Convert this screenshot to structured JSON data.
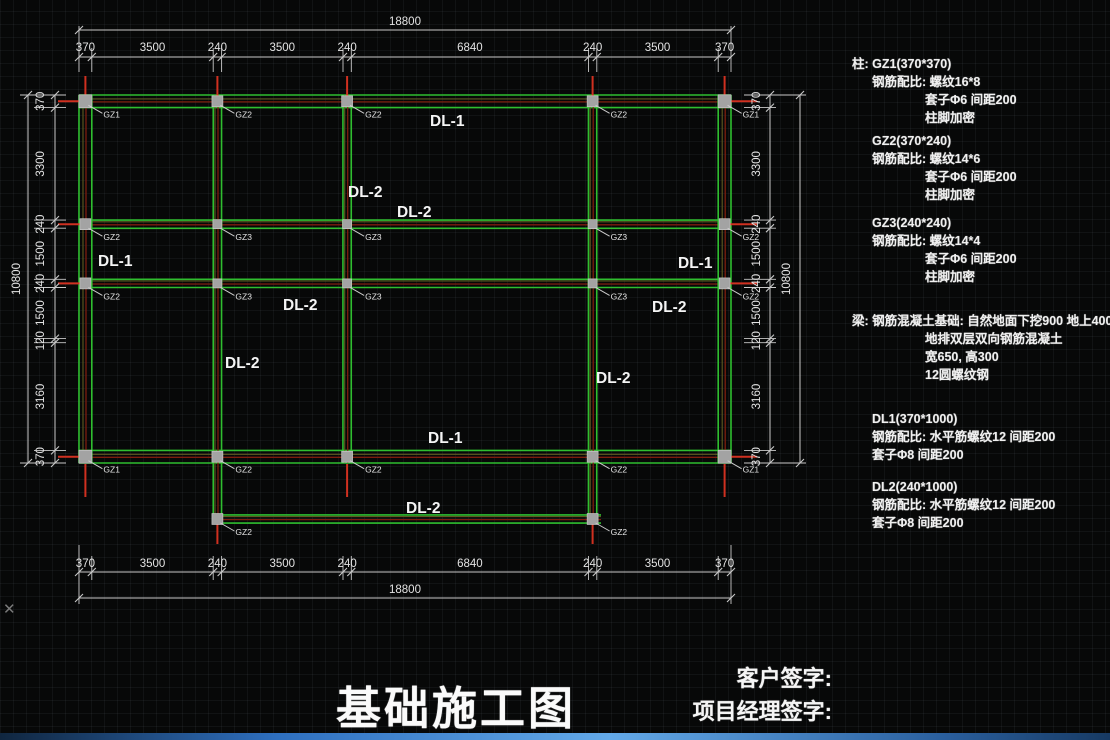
{
  "title": "基础施工图",
  "signatures": {
    "client": "客户签字:",
    "manager": "项目经理签字:"
  },
  "notes_lines": [
    {
      "t": "柱: GZ1(370*370)",
      "ind": 0,
      "gap": 0
    },
    {
      "t": "钢筋配比: 螺纹16*8",
      "ind": 1,
      "gap": 2
    },
    {
      "t": "套子Φ6 间距200",
      "ind": 2,
      "gap": 2
    },
    {
      "t": "柱脚加密",
      "ind": 2,
      "gap": 2
    },
    {
      "t": "GZ2(370*240)",
      "ind": 1,
      "gap": 7
    },
    {
      "t": "钢筋配比: 螺纹14*6",
      "ind": 1,
      "gap": 2
    },
    {
      "t": "套子Φ6 间距200",
      "ind": 2,
      "gap": 2
    },
    {
      "t": "柱脚加密",
      "ind": 2,
      "gap": 2
    },
    {
      "t": "GZ3(240*240)",
      "ind": 1,
      "gap": 12
    },
    {
      "t": "钢筋配比: 螺纹14*4",
      "ind": 1,
      "gap": 2
    },
    {
      "t": "套子Φ6 间距200",
      "ind": 2,
      "gap": 2
    },
    {
      "t": "柱脚加密",
      "ind": 2,
      "gap": 2
    },
    {
      "t": "梁: 钢筋混凝土基础: 自然地面下挖900 地上400",
      "ind": 0,
      "gap": 28
    },
    {
      "t": "地排双层双向钢筋混凝土",
      "ind": 2,
      "gap": 2
    },
    {
      "t": "宽650, 高300",
      "ind": 2,
      "gap": 2
    },
    {
      "t": "12圆螺纹钢",
      "ind": 2,
      "gap": 2
    },
    {
      "t": "DL1(370*1000)",
      "ind": 1,
      "gap": 28
    },
    {
      "t": "钢筋配比: 水平筋螺纹12 间距200",
      "ind": 1,
      "gap": 2
    },
    {
      "t": "套子Φ8 间距200",
      "ind": 1,
      "gap": 2
    },
    {
      "t": "DL2(240*1000)",
      "ind": 1,
      "gap": 16
    },
    {
      "t": "钢筋配比: 水平筋螺纹12 间距200",
      "ind": 1,
      "gap": 2
    },
    {
      "t": "套子Φ8 间距200",
      "ind": 1,
      "gap": 2
    }
  ],
  "colors": {
    "green": "#2fbe2f",
    "bright_red": "#d03020",
    "dark_red": "#7d1d0e",
    "olive": "#5f5a22",
    "column_gray": "#a3a3a3",
    "column_edge": "#d0d0d0",
    "dim_line": "#c9c9c9",
    "dim_text": "#e3e3e3",
    "label_white": "#f5f5f5",
    "leader": "#cccccc"
  },
  "plan": {
    "extent": {
      "x0": 79,
      "x1": 731,
      "y0": 95,
      "y1": 463
    },
    "cols": [
      {
        "x": 85.4,
        "w": 12.8
      },
      {
        "x": 217.4,
        "w": 8.3
      },
      {
        "x": 347.1,
        "w": 8.3
      },
      {
        "x": 592.6,
        "w": 8.3
      },
      {
        "x": 724.6,
        "w": 12.8
      }
    ],
    "rows": [
      {
        "y": 101.3,
        "w": 12.6
      },
      {
        "y": 224.2,
        "w": 8.2
      },
      {
        "y": 283.4,
        "w": 8.2
      },
      {
        "y": 456.7,
        "w": 12.6
      }
    ],
    "extra_beam": {
      "y": 519,
      "x0": 217.4,
      "x1": 601,
      "w": 8.2
    },
    "x_bounds": [
      79,
      91.8,
      213.2,
      221.6,
      343,
      351.3,
      588.5,
      596.8,
      718.2,
      731
    ],
    "y_bounds": [
      95,
      107.6,
      220.1,
      228.2,
      279.3,
      287.5,
      338.6,
      342.7,
      450.4,
      463
    ],
    "dim_top": {
      "total": "18800",
      "segments": [
        "370",
        "3500",
        "240",
        "3500",
        "240",
        "6840",
        "240",
        "3500",
        "370"
      ]
    },
    "dim_bottom": {
      "total": "18800",
      "segments": [
        "370",
        "3500",
        "240",
        "3500",
        "240",
        "6840",
        "240",
        "3500",
        "370"
      ]
    },
    "dim_left": {
      "total": "10800",
      "segments": [
        "370",
        "3300",
        "240",
        "1500",
        "240",
        "1500",
        "120",
        "3160",
        "370"
      ]
    },
    "dim_right": {
      "total": "10800",
      "segments": [
        "370",
        "3300",
        "240",
        "1500",
        "240",
        "1500",
        "120",
        "3160",
        "370"
      ]
    },
    "beam_labels": [
      {
        "t": "DL-1",
        "x": 430,
        "y": 126
      },
      {
        "t": "DL-2",
        "x": 348,
        "y": 197
      },
      {
        "t": "DL-2",
        "x": 397,
        "y": 217
      },
      {
        "t": "DL-1",
        "x": 98,
        "y": 266
      },
      {
        "t": "DL-2",
        "x": 283,
        "y": 310
      },
      {
        "t": "DL-2",
        "x": 652,
        "y": 312
      },
      {
        "t": "DL-1",
        "x": 678,
        "y": 268
      },
      {
        "t": "DL-2",
        "x": 225,
        "y": 368
      },
      {
        "t": "DL-2",
        "x": 596,
        "y": 383
      },
      {
        "t": "DL-1",
        "x": 428,
        "y": 443
      },
      {
        "t": "DL-2",
        "x": 406,
        "y": 513
      }
    ],
    "nodes": [
      {
        "t": "GZ1",
        "x": 85.4,
        "y": 101.3
      },
      {
        "t": "GZ2",
        "x": 217.4,
        "y": 101.3
      },
      {
        "t": "GZ2",
        "x": 347.1,
        "y": 101.3
      },
      {
        "t": "GZ2",
        "x": 592.6,
        "y": 101.3
      },
      {
        "t": "GZ1",
        "x": 724.6,
        "y": 101.3
      },
      {
        "t": "GZ2",
        "x": 85.4,
        "y": 224.2
      },
      {
        "t": "GZ3",
        "x": 217.4,
        "y": 224.2
      },
      {
        "t": "GZ3",
        "x": 347.1,
        "y": 224.2
      },
      {
        "t": "GZ3",
        "x": 592.6,
        "y": 224.2
      },
      {
        "t": "GZ2",
        "x": 724.6,
        "y": 224.2
      },
      {
        "t": "GZ2",
        "x": 85.4,
        "y": 283.4
      },
      {
        "t": "GZ3",
        "x": 217.4,
        "y": 283.4
      },
      {
        "t": "GZ3",
        "x": 347.1,
        "y": 283.4
      },
      {
        "t": "GZ3",
        "x": 592.6,
        "y": 283.4
      },
      {
        "t": "GZ2",
        "x": 724.6,
        "y": 283.4
      },
      {
        "t": "GZ1",
        "x": 85.4,
        "y": 456.7
      },
      {
        "t": "GZ2",
        "x": 217.4,
        "y": 456.7
      },
      {
        "t": "GZ2",
        "x": 347.1,
        "y": 456.7
      },
      {
        "t": "GZ2",
        "x": 592.6,
        "y": 456.7
      },
      {
        "t": "GZ1",
        "x": 724.6,
        "y": 456.7
      },
      {
        "t": "GZ2",
        "x": 217.4,
        "y": 519
      },
      {
        "t": "GZ2",
        "x": 592.6,
        "y": 519
      }
    ],
    "node_sizes": {
      "GZ1": 13,
      "GZ2": 11,
      "GZ3": 9
    }
  }
}
